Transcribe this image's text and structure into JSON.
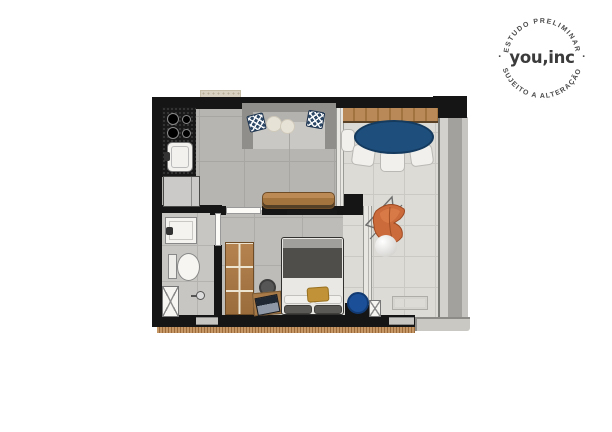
{
  "logo": {
    "brand": "you,inc",
    "arc_top": "ESTUDO PRELIMINAR",
    "arc_bottom": "SUJEITO A ALTERAÇÃO",
    "separator_dot": "·"
  },
  "floorplan": {
    "type": "studio-apartment-floor-plan",
    "fixtures": [
      "cooktop",
      "kitchen-sink",
      "refrigerator",
      "sofa",
      "chevron-throw-pillows",
      "sideboard",
      "tv",
      "round-dining-table",
      "dining-chairs",
      "butterfly-chair",
      "decor-sphere",
      "floor-drain",
      "wardrobe",
      "desk",
      "laptop",
      "stool",
      "double-bed",
      "bed-pillows",
      "mustard-cushion",
      "blue-pouf",
      "bathroom-vanity",
      "toilet",
      "shower-head",
      "glass-sliding-doors",
      "balcony-railing"
    ],
    "colors": {
      "wall": "#151515",
      "dining_table_blue": "#1d4e7c",
      "pouf_blue": "#1b4f97",
      "butterfly_chair_orange": "#cb6b3c",
      "cushion_mustard": "#c19238",
      "pillow_navy": "#2d4866",
      "wood": "#b0814b",
      "interior_floor_gray": "#b6b5b1",
      "balcony_floor": "#dcdbd5"
    }
  }
}
